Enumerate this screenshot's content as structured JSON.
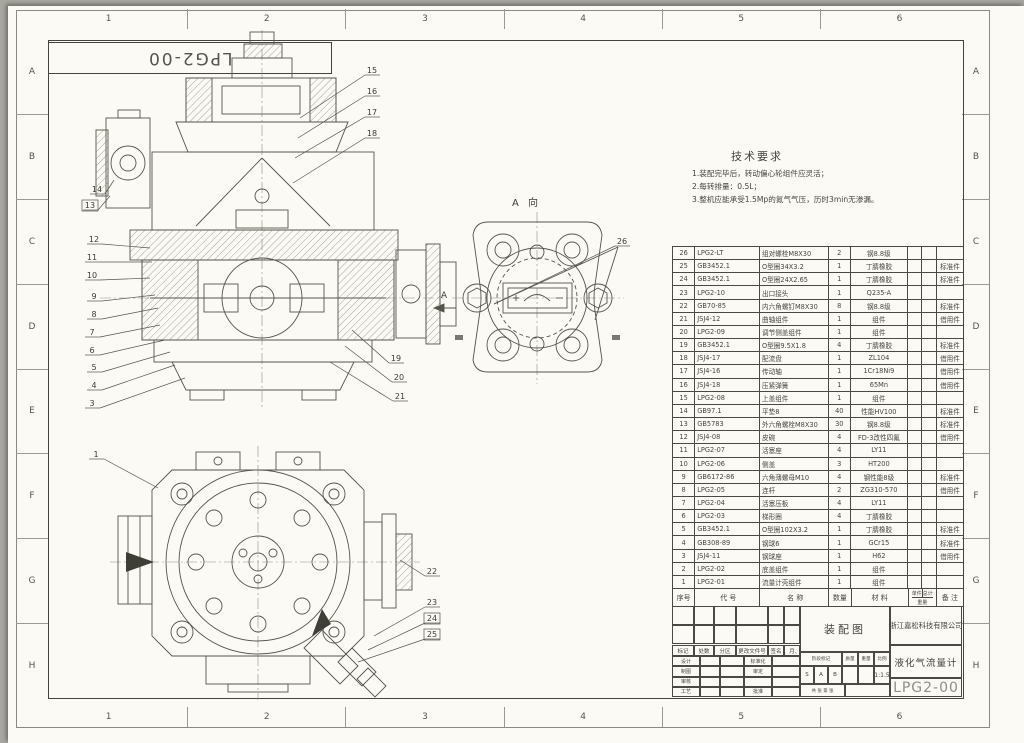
{
  "sheet": {
    "zones": {
      "columns": [
        "1",
        "2",
        "3",
        "4",
        "5",
        "6"
      ],
      "rows": [
        "A",
        "B",
        "C",
        "D",
        "E",
        "F",
        "G",
        "H"
      ]
    },
    "flipped_drawing_number": "LPG2-00"
  },
  "tech_requirements": {
    "title": "技术要求",
    "lines": [
      "1.装配完毕后，转动偏心轮组件应灵活；",
      "2.每转排量：0.5L；",
      "3.整机应能承受1.5Mp的氮气气压，历时3min无渗漏。"
    ]
  },
  "views": {
    "a_view_label": "A 向",
    "section_label": "A",
    "callouts_main": [
      "15",
      "16",
      "17",
      "18",
      "14",
      "13",
      "12",
      "11",
      "10",
      "9",
      "8",
      "7",
      "6",
      "5",
      "4",
      "3",
      "19",
      "20",
      "21"
    ],
    "callouts_front": [
      "1",
      "22",
      "23",
      "24",
      "25"
    ],
    "callouts_a_view": [
      "26"
    ]
  },
  "bom": {
    "headers": {
      "seq": "序号",
      "code": "代  号",
      "name": "名  称",
      "qty": "数量",
      "material": "材  料",
      "unit": "单件",
      "total": "总计",
      "weight": "重量",
      "notes": "备 注"
    },
    "rows": [
      {
        "seq": "26",
        "code": "LPG2-LT",
        "name": "组对螺栓M8X30",
        "qty": "2",
        "material": "钢8.8级",
        "notes": ""
      },
      {
        "seq": "25",
        "code": "GB3452.1",
        "name": "O型圈34X3.2",
        "qty": "1",
        "material": "丁腈橡胶",
        "notes": "标准件"
      },
      {
        "seq": "24",
        "code": "GB3452.1",
        "name": "O型圈24X2.65",
        "qty": "1",
        "material": "丁腈橡胶",
        "notes": "标准件"
      },
      {
        "seq": "23",
        "code": "LPG2-10",
        "name": "出口接头",
        "qty": "1",
        "material": "Q235-A",
        "notes": ""
      },
      {
        "seq": "22",
        "code": "GB70-85",
        "name": "内六角螺钉M8X30",
        "qty": "8",
        "material": "钢8.8级",
        "notes": "标准件"
      },
      {
        "seq": "21",
        "code": "JSJ4-12",
        "name": "曲轴组件",
        "qty": "1",
        "material": "组件",
        "notes": "借用件"
      },
      {
        "seq": "20",
        "code": "LPG2-09",
        "name": "调节侧盖组件",
        "qty": "1",
        "material": "组件",
        "notes": ""
      },
      {
        "seq": "19",
        "code": "GB3452.1",
        "name": "O型圈9.5X1.8",
        "qty": "4",
        "material": "丁腈橡胶",
        "notes": "标准件"
      },
      {
        "seq": "18",
        "code": "JSJ4-17",
        "name": "配流盘",
        "qty": "1",
        "material": "ZL104",
        "notes": "借用件"
      },
      {
        "seq": "17",
        "code": "JSJ4-16",
        "name": "传动轴",
        "qty": "1",
        "material": "1Cr18Ni9",
        "notes": "借用件"
      },
      {
        "seq": "16",
        "code": "JSJ4-18",
        "name": "压紧弹簧",
        "qty": "1",
        "material": "65Mn",
        "notes": "借用件"
      },
      {
        "seq": "15",
        "code": "LPG2-08",
        "name": "上盖组件",
        "qty": "1",
        "material": "组件",
        "notes": ""
      },
      {
        "seq": "14",
        "code": "GB97.1",
        "name": "平垫8",
        "qty": "40",
        "material": "性能HV100",
        "notes": "标准件"
      },
      {
        "seq": "13",
        "code": "GB5783",
        "name": "外六角螺栓M8X30",
        "qty": "30",
        "material": "钢8.8级",
        "notes": "标准件"
      },
      {
        "seq": "12",
        "code": "JSJ4-08",
        "name": "皮碗",
        "qty": "4",
        "material": "FD-3改性四氟",
        "notes": "借用件"
      },
      {
        "seq": "11",
        "code": "LPG2-07",
        "name": "活塞座",
        "qty": "4",
        "material": "LY11",
        "notes": ""
      },
      {
        "seq": "10",
        "code": "LPG2-06",
        "name": "侧盖",
        "qty": "3",
        "material": "HT200",
        "notes": ""
      },
      {
        "seq": "9",
        "code": "GB6172-86",
        "name": "六角薄螺母M10",
        "qty": "4",
        "material": "钢性能8级",
        "notes": "标准件"
      },
      {
        "seq": "8",
        "code": "LPG2-05",
        "name": "连杆",
        "qty": "2",
        "material": "ZG310-570",
        "notes": "借用件"
      },
      {
        "seq": "7",
        "code": "LPG2-04",
        "name": "活塞压板",
        "qty": "4",
        "material": "LY11",
        "notes": ""
      },
      {
        "seq": "6",
        "code": "LPG2-03",
        "name": "梯形圈",
        "qty": "4",
        "material": "丁腈橡胶",
        "notes": ""
      },
      {
        "seq": "5",
        "code": "GB3452.1",
        "name": "O型圈102X3.2",
        "qty": "1",
        "material": "丁腈橡胶",
        "notes": "标准件"
      },
      {
        "seq": "4",
        "code": "GB308-89",
        "name": "钢球6",
        "qty": "1",
        "material": "GCr15",
        "notes": "标准件"
      },
      {
        "seq": "3",
        "code": "JSJ4-11",
        "name": "钢球座",
        "qty": "1",
        "material": "H62",
        "notes": "借用件"
      },
      {
        "seq": "2",
        "code": "LPG2-02",
        "name": "底盖组件",
        "qty": "1",
        "material": "组件",
        "notes": ""
      },
      {
        "seq": "1",
        "code": "LPG2-01",
        "name": "流量计壳组件",
        "qty": "1",
        "material": "组件",
        "notes": ""
      }
    ]
  },
  "title_block": {
    "revision_headers": [
      "标记",
      "处数",
      "分区",
      "更改文件号",
      "签名",
      "年、月、日"
    ],
    "sign_rows": [
      [
        "设计",
        "标准化"
      ],
      [
        "制图",
        "审定"
      ],
      [
        "审核",
        ""
      ],
      [
        "工艺",
        "批准"
      ]
    ],
    "drawing_type": "装配图",
    "stage_header": "阶段标记",
    "mass_header": "质量",
    "weight_header": "重量",
    "scale_header": "比例",
    "stage_marks": [
      "S",
      "A",
      "B"
    ],
    "scale_value": "1:1.5",
    "sheet_note": "共 张 第 张",
    "company": "浙江嘉松科技有限公司",
    "product": "液化气流量计",
    "drawing_number": "LPG2-00"
  }
}
